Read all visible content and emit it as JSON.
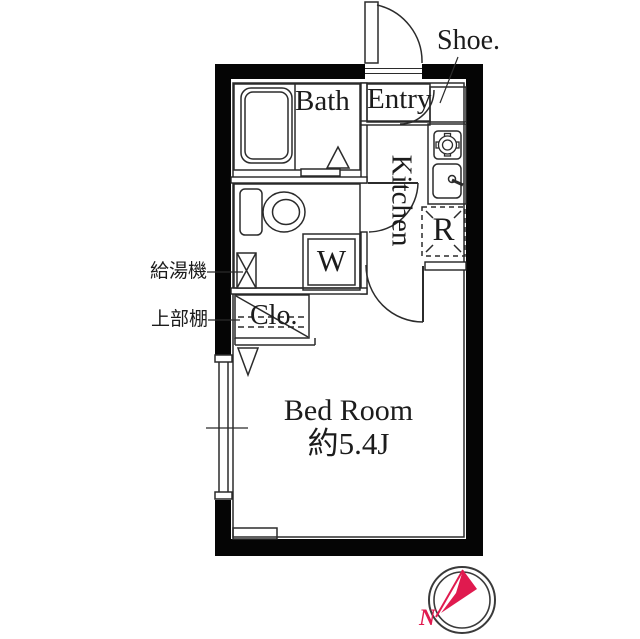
{
  "plan": {
    "type": "apartment-floor-plan",
    "rooms": {
      "bath": {
        "label": "Bath"
      },
      "entry": {
        "label": "Entry"
      },
      "kitchen": {
        "label": "Kitchen"
      },
      "bedroom": {
        "label": "Bed Room",
        "size": "約5.4J"
      }
    },
    "fixtures": {
      "shoe_cabinet": {
        "label": "Shoe."
      },
      "washing_machine": {
        "label": "W"
      },
      "refrigerator": {
        "label": "R"
      },
      "closet": {
        "label": "Clo."
      },
      "water_heater": {
        "label": "給湯機"
      },
      "upper_shelf": {
        "label": "上部棚"
      }
    },
    "compass": {
      "north_label": "N"
    },
    "colors": {
      "wall": "#050505",
      "line": "#2b2b2b",
      "accent_red": "#e01a4f"
    }
  }
}
